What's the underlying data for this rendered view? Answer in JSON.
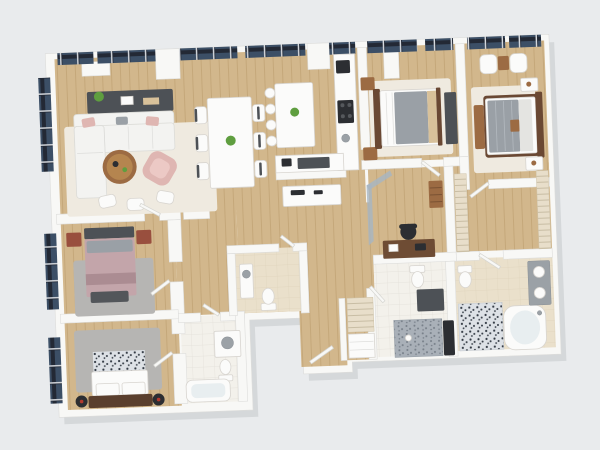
{
  "scene": {
    "type": "3d-floor-plan-render",
    "view": "top-down isometric",
    "description": "Photorealistic 3D floor plan render of a four-bedroom apartment with open living, dining and kitchen, home office, walk-in closet and four bathrooms; window bands along the top and left walls"
  },
  "colors": {
    "bg": "#e9ebed",
    "plan_shadow": "rgba(40,46,58,0.10)",
    "wall": "#f8f8f6",
    "wall_shade": "#dddddb",
    "wood_floor": "#d2b78c",
    "wood_line": "#c3a678",
    "window_frame": "#232935",
    "window_glass": "#3c4f66",
    "window_mullion": "#d9dde2",
    "glass_partition": "#a6b5c3",
    "rug_cream": "#efeae0",
    "rug_gray": "#b6b5b3",
    "sofa_white": "#f3f3f1",
    "cushion_blush": "#dfb6b2",
    "furniture_dark": "#4d5156",
    "furniture_black": "#2c2e32",
    "wood_brown": "#9c6b43",
    "wood_dark": "#6a4833",
    "chestnut": "#994f3e",
    "bed_gray": "#9aa0a6",
    "bed_mauve": "#c3a5aa",
    "bed_tan": "#d8c19a",
    "porcelain": "#fbfbfa",
    "counter_gray": "#9ba1a6",
    "tile_beige": "#eae0cb",
    "tile_white": "#f3f1eb",
    "mosaic_a_bg": "#dde1e6",
    "mosaic_a_dot": "#333a44",
    "mosaic_b_bg": "#a9b0b8",
    "mosaic_b_dot": "#767e88",
    "plant_green": "#5f9e3f",
    "accent_red": "#b23a2e",
    "desk_walnut": "#6e4c34"
  },
  "rooms": [
    {
      "id": "living-room",
      "furniture": [
        "media-sideboard",
        "plant",
        "sectional-sofa",
        "throw-pillows",
        "coffee-table",
        "accent-armchair",
        "area-rug",
        "floor-cushions"
      ]
    },
    {
      "id": "dining-area",
      "furniture": [
        "dining-table",
        "dining-chairs-x6",
        "centerpiece"
      ]
    },
    {
      "id": "kitchen",
      "furniture": [
        "island",
        "bar-stools-x4",
        "fruit-bowl",
        "tall-counter",
        "cooktop",
        "coffee-machine",
        "lower-counter",
        "hall-console"
      ]
    },
    {
      "id": "guest-bedroom",
      "furniture": [
        "double-bed",
        "nightstands-x2",
        "wardrobe",
        "area-rug"
      ]
    },
    {
      "id": "master-bedroom",
      "furniture": [
        "double-bed",
        "nightstands-x2",
        "armchairs-x2",
        "side-table",
        "bench",
        "area-rug"
      ]
    },
    {
      "id": "home-office",
      "furniture": [
        "desk",
        "office-chair",
        "wall-shelf",
        "glass-partition"
      ]
    },
    {
      "id": "walk-in-closet",
      "furniture": [
        "shelving-units-x2"
      ]
    },
    {
      "id": "master-bathroom",
      "furniture": [
        "corner-bathtub",
        "mosaic-shower",
        "double-vanity",
        "toilet"
      ]
    },
    {
      "id": "second-bathroom",
      "furniture": [
        "toilet",
        "dark-vanity",
        "mosaic-shower-floor",
        "bench"
      ]
    },
    {
      "id": "hall-bathroom",
      "furniture": [
        "vanity",
        "toilet"
      ]
    },
    {
      "id": "family-bathroom",
      "furniture": [
        "vanity",
        "toilet",
        "bathtub"
      ]
    },
    {
      "id": "bedroom-three",
      "furniture": [
        "double-bed",
        "headboard",
        "nightstands-x2",
        "bench",
        "area-rug"
      ]
    },
    {
      "id": "bedroom-four",
      "furniture": [
        "double-bed",
        "patterned-blanket",
        "nightstands-x2",
        "area-rug"
      ]
    },
    {
      "id": "hallway",
      "furniture": [
        "entry-door",
        "closet-shelves",
        "drawer-unit"
      ]
    }
  ]
}
